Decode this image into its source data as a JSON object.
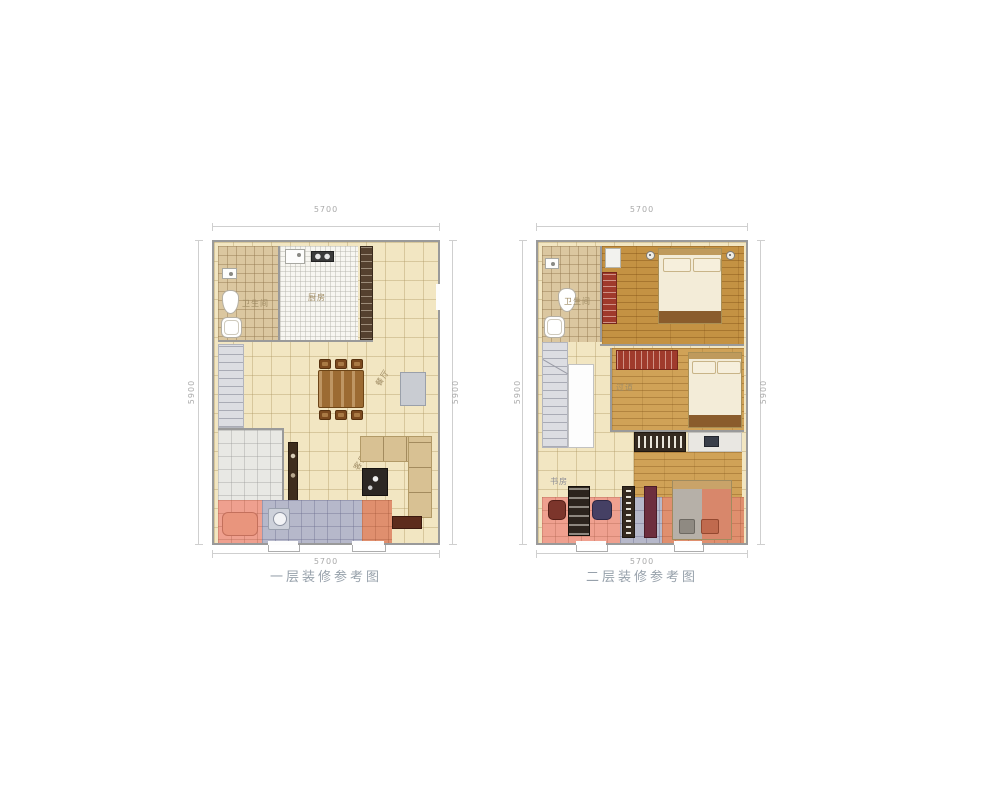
{
  "page": {
    "background": "#ffffff"
  },
  "palette": {
    "floor_tile_cream": "#f2e6c2",
    "floor_wood": "#c49243",
    "balcony_pink": "#efa08f",
    "balcony_lavender": "#b6b8ca",
    "balcony_salmon": "#e08f6e",
    "wardrobe_red": "#a03a2c",
    "caption_grey": "#97a1ab"
  },
  "plans": [
    {
      "caption": "一层装修参考图",
      "dims": {
        "top": "5700",
        "bottom": "5700",
        "left": "5900",
        "right": "5900"
      },
      "rooms": {
        "bathroom": "卫生间",
        "kitchen": "厨房",
        "dining": "餐厅",
        "living": "客厅"
      }
    },
    {
      "caption": "二层装修参考图",
      "dims": {
        "top": "5700",
        "bottom": "5700",
        "left": "5900",
        "right": "5900"
      },
      "rooms": {
        "bathroom": "卫生间",
        "corridor": "过道",
        "study": "书房"
      }
    }
  ]
}
